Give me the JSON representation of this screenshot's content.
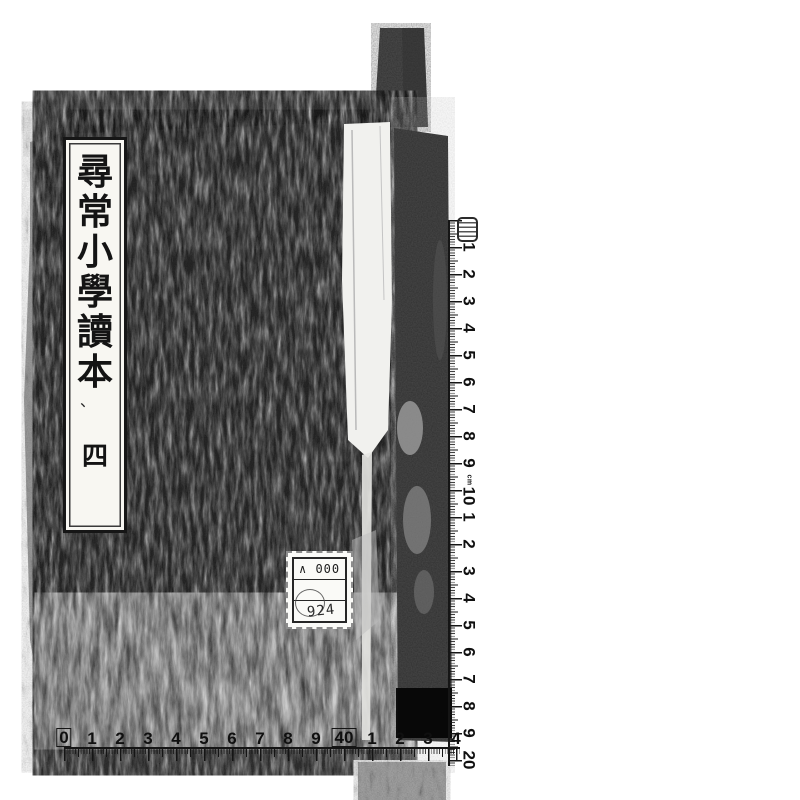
{
  "book": {
    "title_label": {
      "chars": [
        "尋",
        "常",
        "小",
        "學",
        "讀",
        "本"
      ],
      "mark": "、",
      "volume": "四"
    },
    "sticker": {
      "row1": "∧ 000",
      "row2": "",
      "row3": "924"
    }
  },
  "rulers": {
    "vertical": {
      "marks": [
        {
          "label": "1"
        },
        {
          "label": "2"
        },
        {
          "label": "3"
        },
        {
          "label": "4"
        },
        {
          "label": "5"
        },
        {
          "label": "6"
        },
        {
          "label": "7"
        },
        {
          "label": "8"
        },
        {
          "label": "9"
        },
        {
          "label": "10",
          "unit": "cm"
        },
        {
          "label": "1"
        },
        {
          "label": "2"
        },
        {
          "label": "3"
        },
        {
          "label": "4"
        },
        {
          "label": "5"
        },
        {
          "label": "6"
        },
        {
          "label": "7"
        },
        {
          "label": "8"
        },
        {
          "label": "9"
        },
        {
          "label": "20"
        }
      ]
    },
    "horizontal": {
      "marks": [
        {
          "label": "0",
          "boxed": true,
          "above": "cm"
        },
        {
          "label": "1"
        },
        {
          "label": "2"
        },
        {
          "label": "3"
        },
        {
          "label": "4"
        },
        {
          "label": "5"
        },
        {
          "label": "6"
        },
        {
          "label": "7"
        },
        {
          "label": "8"
        },
        {
          "label": "9"
        },
        {
          "label": "40",
          "boxed": true,
          "above": "0cm"
        },
        {
          "label": "1"
        },
        {
          "label": "2"
        },
        {
          "label": "3"
        },
        {
          "label": "4"
        }
      ],
      "end_mark": "←"
    }
  },
  "colors": {
    "paper": "#ffffff",
    "cover_black": "#0f0f0f",
    "edge_gray": "#9a9a9a",
    "strap_gray": "#a8a8a8",
    "ruler_ink": "#151515",
    "label_paper": "#f8f7f2"
  }
}
